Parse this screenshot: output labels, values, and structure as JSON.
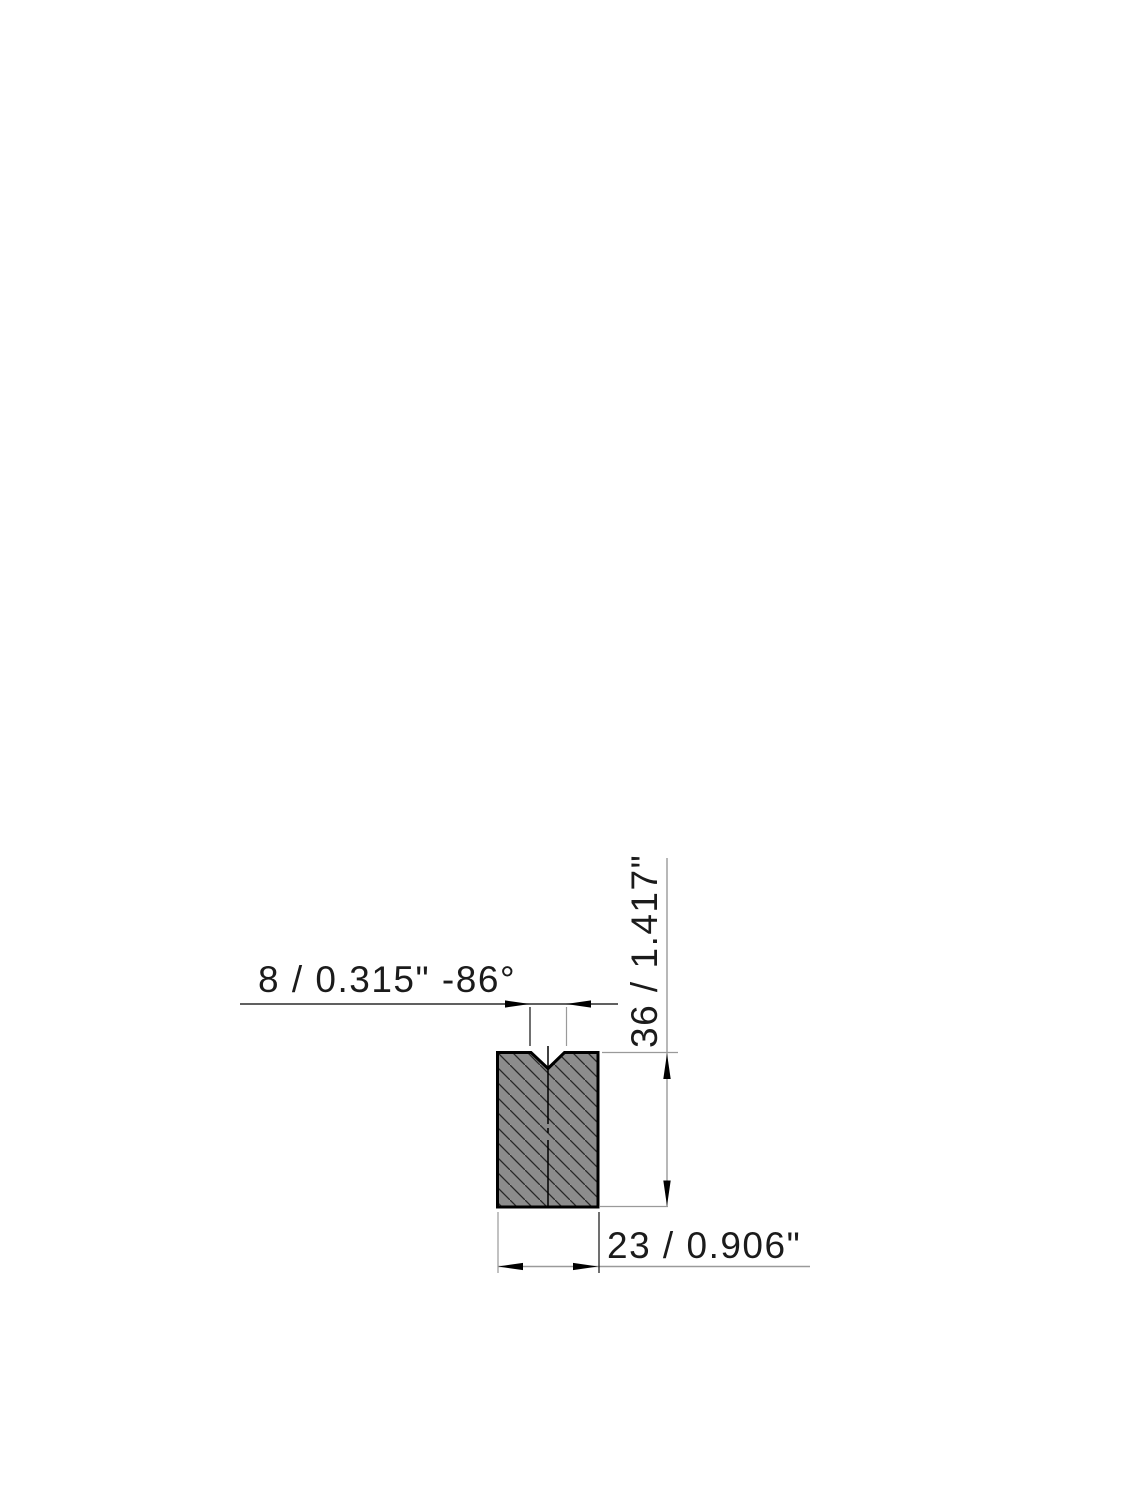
{
  "drawing": {
    "type": "technical-drawing",
    "subject": "press-brake v-die cross-section",
    "dimensions": {
      "v_opening": {
        "label": "8 / 0.315\" -86°",
        "value_mm": "8",
        "value_in": "0.315\"",
        "angle": "-86°"
      },
      "height": {
        "label": "36 / 1.417\"",
        "value_mm": "36",
        "value_in": "1.417\""
      },
      "width": {
        "label": "23 / 0.906\"",
        "value_mm": "23",
        "value_in": "0.906\""
      }
    },
    "colors": {
      "background": "#ffffff",
      "part_fill": "#8c8c8c",
      "part_outline": "#000000",
      "hatch_line": "#262626",
      "dim_line_dark": "#2b2b2b",
      "dim_line_gray": "#9a9a9a",
      "arrow": "#000000",
      "text": "#1b1b1b"
    }
  }
}
